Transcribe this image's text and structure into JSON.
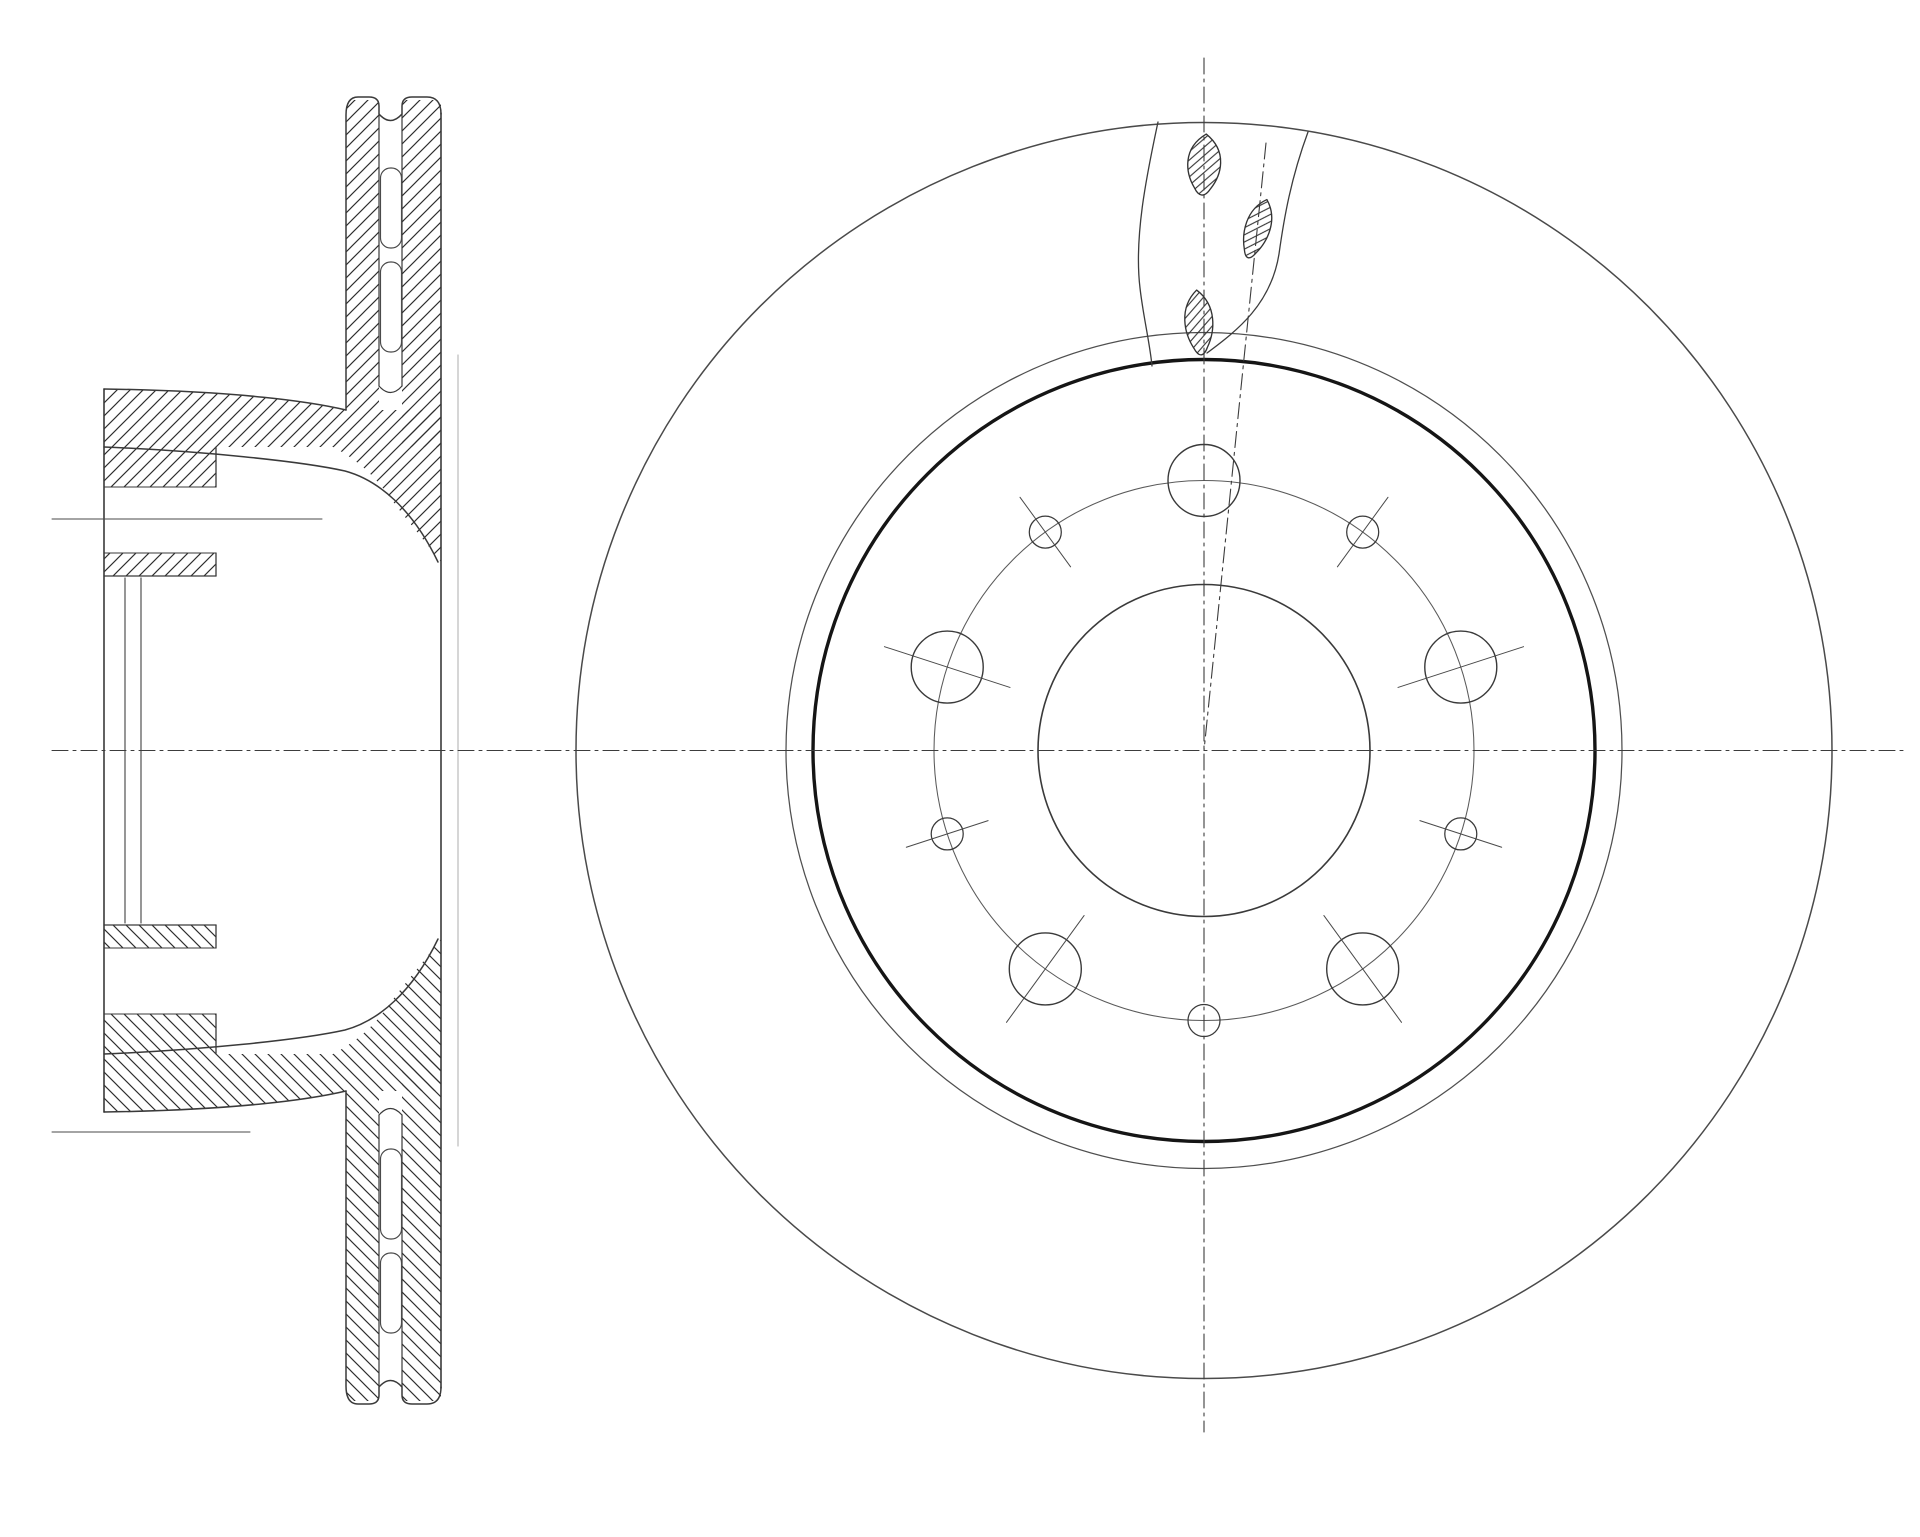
{
  "drawing": {
    "title": "brake-disc-technical-drawing",
    "canvas": {
      "width": 1920,
      "height": 1537,
      "background": "#ffffff"
    },
    "centerlines": {
      "color": "#3c3c3c",
      "width": 1.1,
      "dash": "16 5 3 5",
      "horizontal": {
        "y": 750.5,
        "x1": 52,
        "x2": 1908
      },
      "vertical": {
        "x": 1204,
        "y1": 58,
        "y2": 1432
      },
      "inclined": {
        "x1": 1266,
        "y1": 143,
        "x2": 1204,
        "y2": 750.5
      }
    },
    "front_view": {
      "cx": 1204,
      "cy": 750.5,
      "circles": [
        {
          "name": "outer-diameter-circle",
          "r": 628,
          "stroke": "#4a4a4a",
          "width": 1.5
        },
        {
          "name": "swept-band-circle",
          "r": 418,
          "stroke": "#4f4f4f",
          "width": 1.25
        },
        {
          "name": "friction-inner-edge-circle",
          "r": 391,
          "stroke": "#151515",
          "width": 3.4
        },
        {
          "name": "bolt-circle",
          "r": 270,
          "stroke": "#5a5a5a",
          "width": 1.05
        },
        {
          "name": "center-bore-circle",
          "r": 166,
          "stroke": "#3a3a3a",
          "width": 1.6
        }
      ],
      "bolt_holes": {
        "radius": 36,
        "angles_deg": [
          18,
          90,
          162,
          234,
          306
        ],
        "tick_overhang": 30,
        "stroke": "#3a3a3a",
        "width": 1.4
      },
      "small_holes": {
        "radius": 16,
        "angles_deg": [
          54,
          126,
          198,
          270,
          342
        ],
        "tick_overhang": 27,
        "stroke": "#3a3a3a",
        "width": 1.25
      },
      "cutaway": {
        "stroke": "#3c3c3c",
        "width": 1.3,
        "left_break": "M1158,122 C1146,178 1134,238 1140,288 C1143,315 1150,344 1152,366",
        "right_break": "M1308,132 C1291,178 1284,218 1279,254 C1271,304 1238,330 1207,353",
        "slots": [
          {
            "name": "vent-slot-top",
            "cx": 1204,
            "cy": 166,
            "rx": 20,
            "ry": 32,
            "rot": 4
          },
          {
            "name": "vent-slot-right",
            "cx": 1257,
            "cy": 230,
            "rx": 15,
            "ry": 32,
            "rot": 18
          },
          {
            "name": "vent-slot-bottom",
            "cx": 1199,
            "cy": 324,
            "rx": 17,
            "ry": 34,
            "rot": -4
          }
        ],
        "hatch": {
          "spacing": 9,
          "color": "#2f2f2f",
          "width": 1.1
        }
      }
    },
    "section_view": {
      "cy": 750.5,
      "stroke": "#3a3a3a",
      "width": 1.5,
      "ghost_color": "#bbbbbb",
      "hatch": {
        "spacing": 13,
        "color": "#2e2e2e",
        "width": 1.15
      },
      "x": {
        "face": 104,
        "bore_step1": 125,
        "bore_step2": 141,
        "wall_inner": 216,
        "plate_out_l": 346,
        "plate_out_r": 379,
        "plate_in_l": 402,
        "plate_in_r": 441,
        "ghost": 458
      },
      "y": {
        "top": 97,
        "bottom": 1404,
        "band_top": 389,
        "band_bot": 447,
        "hole_top": 487,
        "hole_bot": 553,
        "bore_top": 576,
        "bore_bot": 925,
        "plate_out_end": 410,
        "gap_top": 114,
        "gap_bot": 386
      },
      "vanes": [
        {
          "x": 380.5,
          "y": 168,
          "w": 21,
          "h": 80,
          "rx": 10
        },
        {
          "x": 380.5,
          "y": 262,
          "w": 21,
          "h": 90,
          "rx": 10
        }
      ],
      "ticks": [
        {
          "x1": 52,
          "x2": 322,
          "y": 519
        },
        {
          "x1": 52,
          "x2": 250,
          "y": 1132
        }
      ]
    }
  }
}
